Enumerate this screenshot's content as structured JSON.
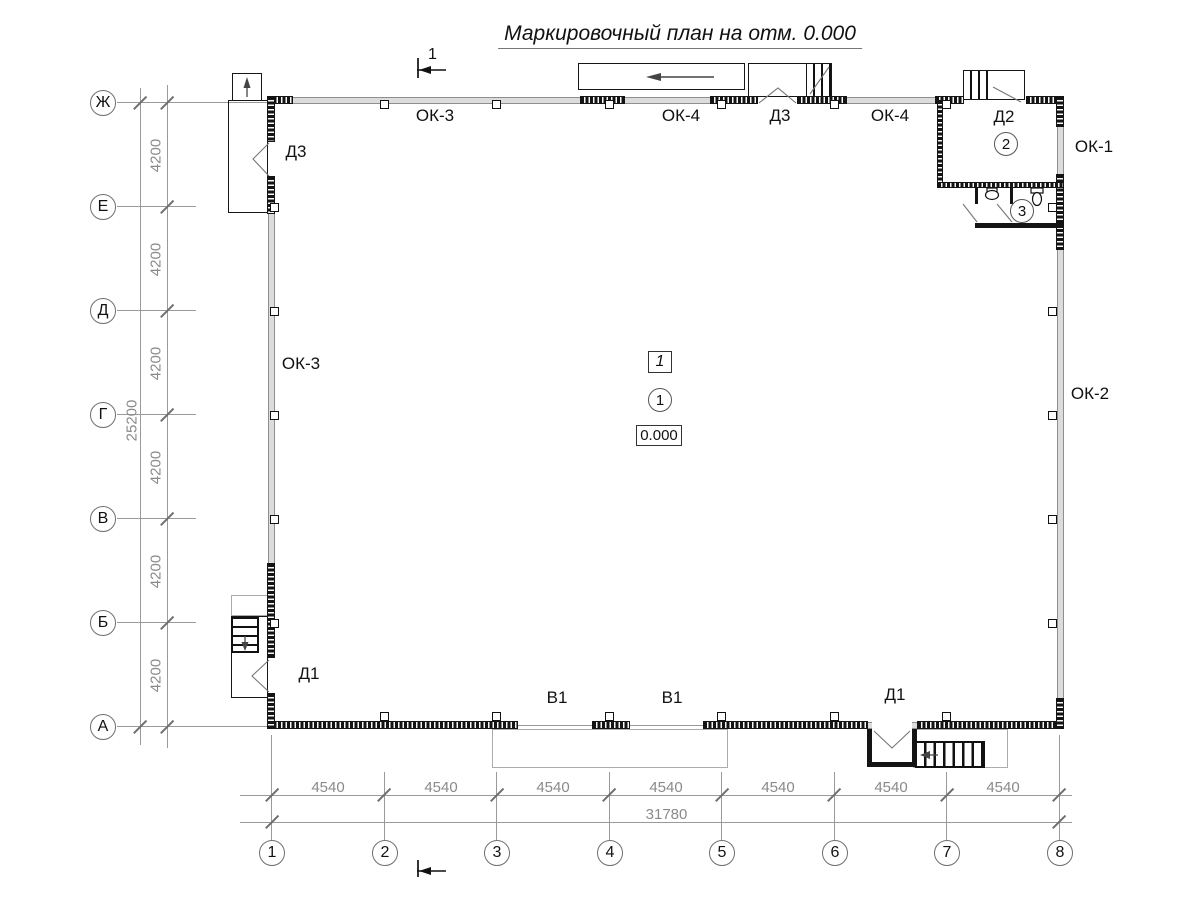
{
  "title": "Маркировочный план на отм. 0.000",
  "grid": {
    "rows": [
      "Ж",
      "Е",
      "Д",
      "Г",
      "В",
      "Б",
      "А"
    ],
    "cols": [
      "1",
      "2",
      "3",
      "4",
      "5",
      "6",
      "7",
      "8"
    ]
  },
  "dims": {
    "row_segments": [
      "4200",
      "4200",
      "4200",
      "4200",
      "4200",
      "4200"
    ],
    "row_total": "25200",
    "col_segments": [
      "4540",
      "4540",
      "4540",
      "4540",
      "4540",
      "4540",
      "4540"
    ],
    "col_total": "31780"
  },
  "marks": {
    "ok3_top": "ОК-3",
    "ok4_a": "ОК-4",
    "d3_top": "Д3",
    "ok4_b": "ОК-4",
    "d2": "Д2",
    "ok1": "ОК-1",
    "ok2": "ОК-2",
    "d3_left": "Д3",
    "ok3_left": "ОК-3",
    "d1_left": "Д1",
    "v1_a": "В1",
    "v1_b": "В1",
    "d1_right": "Д1"
  },
  "rooms": [
    "1",
    "2",
    "3"
  ],
  "floor_type": "1",
  "elevation": "0.000",
  "section": "1"
}
